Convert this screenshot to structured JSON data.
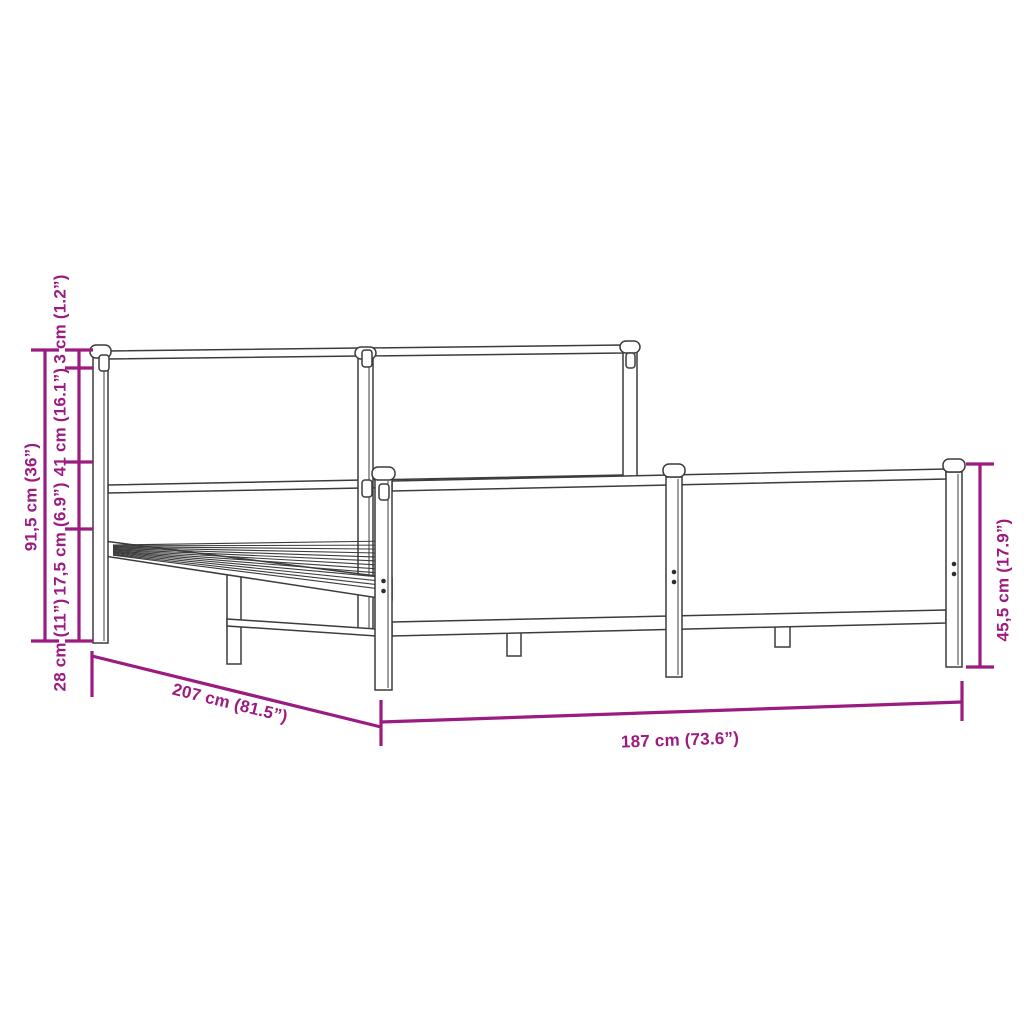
{
  "figure": {
    "type": "product-dimension-diagram",
    "subject": "metal bed frame with headboard and footboard",
    "colors": {
      "dimension_accent": "#9c1b80",
      "drawing_line": "#3c3c3c",
      "background": "#ffffff"
    },
    "dimensions": {
      "total_height": "91,5 cm (36”)",
      "top_section": "3 cm (1.2”)",
      "headboard_panel": "41 cm (16.1”)",
      "mid_section": "17,5 cm (6.9”)",
      "base_section": "28 cm (11”)",
      "length": "207 cm (81.5”)",
      "width": "187 cm (73.6”)",
      "footboard_height": "45,5 cm (17.9”)"
    }
  }
}
